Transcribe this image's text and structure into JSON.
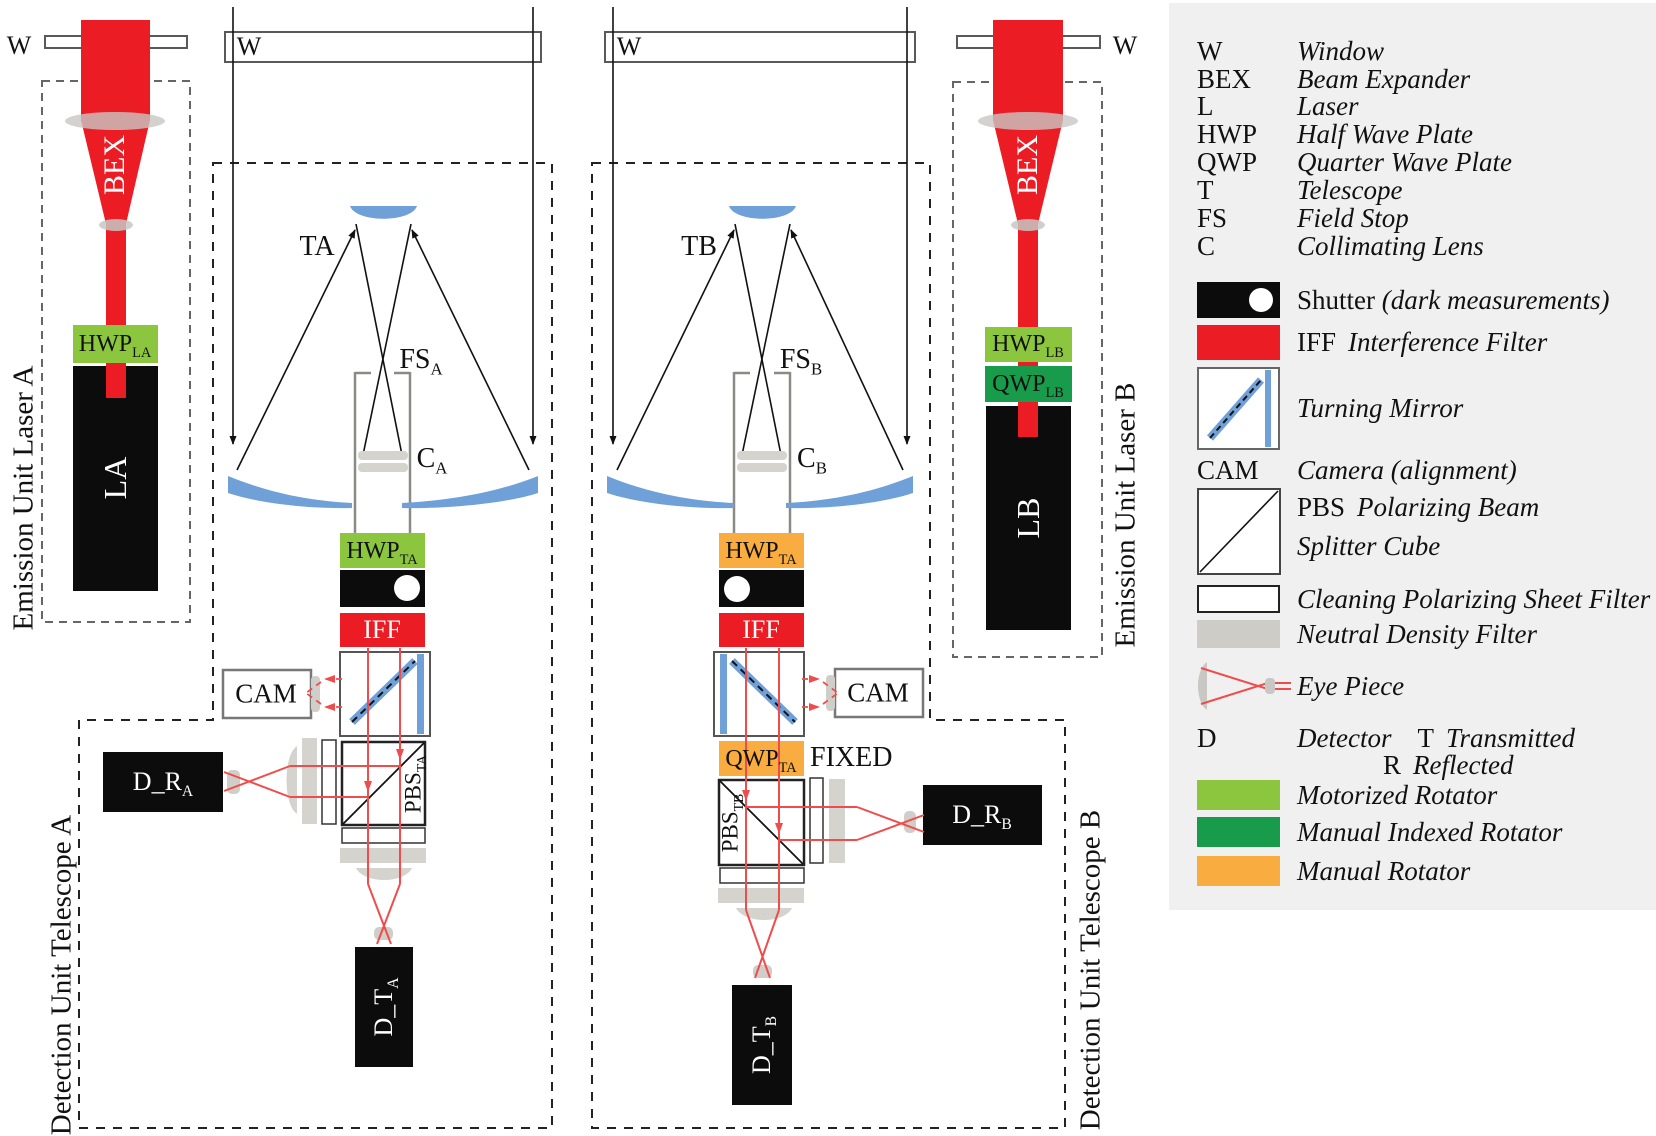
{
  "colors": {
    "beam_red": "#EC1C24",
    "ray_red": "#F04C4C",
    "mirror_blue": "#6FA0D8",
    "motorized_rotator_green": "#8CC63E",
    "manual_indexed_rotator_green": "#189C4B",
    "manual_rotator_orange": "#F9AC40",
    "optic_gray": "#D4D3CE",
    "legend_background": "#F0F0F0"
  },
  "units": {
    "emission_a": {
      "label": "Emission Unit Laser A",
      "window_label": "W",
      "bex": "BEX",
      "hwp": {
        "main": "HWP",
        "sub": "LA"
      },
      "laser": "LA"
    },
    "telescope_a": {
      "window_label": "W",
      "name": "TA",
      "field_stop": {
        "main": "FS",
        "sub": "A"
      },
      "collimator": {
        "main": "C",
        "sub": "A"
      }
    },
    "detection_a": {
      "label": "Detection Unit Telescope A",
      "hwp": {
        "main": "HWP",
        "sub": "TA"
      },
      "iff": "IFF",
      "cam": "CAM",
      "pbs": {
        "main": "PBS",
        "sub": "TA"
      },
      "detector_reflected": {
        "main": "D_R",
        "sub": "A"
      },
      "detector_transmitted": {
        "main": "D_T",
        "sub": "A"
      }
    },
    "telescope_b": {
      "window_label": "W",
      "name": "TB",
      "field_stop": {
        "main": "FS",
        "sub": "B"
      },
      "collimator": {
        "main": "C",
        "sub": "B"
      }
    },
    "detection_b": {
      "label": "Detection Unit Telescope B",
      "hwp": {
        "main": "HWP",
        "sub": "TA"
      },
      "iff": "IFF",
      "cam": "CAM",
      "qwp": {
        "main": "QWP",
        "sub": "TA"
      },
      "qwp_note": "FIXED",
      "pbs": {
        "main": "PBS",
        "sub": "TB"
      },
      "detector_reflected": {
        "main": "D_R",
        "sub": "B"
      },
      "detector_transmitted": {
        "main": "D_T",
        "sub": "B"
      }
    },
    "emission_b": {
      "label": "Emission Unit Laser B",
      "window_label": "W",
      "bex": "BEX",
      "hwp": {
        "main": "HWP",
        "sub": "LB"
      },
      "qwp": {
        "main": "QWP",
        "sub": "LB"
      },
      "laser": "LB"
    }
  },
  "legend": {
    "abbrev_rows": [
      {
        "abbr": "W",
        "desc": "Window"
      },
      {
        "abbr": "BEX",
        "desc": "Beam Expander"
      },
      {
        "abbr": "L",
        "desc": "Laser"
      },
      {
        "abbr": "HWP",
        "desc": "Half Wave Plate"
      },
      {
        "abbr": "QWP",
        "desc": "Quarter Wave Plate"
      },
      {
        "abbr": "T",
        "desc": "Telescope"
      },
      {
        "abbr": "FS",
        "desc": "Field Stop"
      },
      {
        "abbr": "C",
        "desc": "Collimating Lens"
      }
    ],
    "shutter": {
      "label": "Shutter",
      "note": "(dark measurements)"
    },
    "iff": {
      "abbr": "IFF",
      "desc": "Interference Filter"
    },
    "turning_mirror": "Turning Mirror",
    "cam": {
      "abbr": "CAM",
      "desc": "Camera (alignment)"
    },
    "pbs": {
      "abbr": "PBS",
      "desc_line1": "Polarizing Beam",
      "desc_line2": "Splitter Cube"
    },
    "cleaning_filter": "Cleaning Polarizing Sheet Filter",
    "nd_filter": "Neutral Density Filter",
    "eye_piece": "Eye Piece",
    "detector": {
      "abbr": "D",
      "desc": "Detector",
      "t": "T",
      "t_desc": "Transmitted",
      "r": "R",
      "r_desc": "Reflected"
    },
    "rotators": [
      {
        "label": "Motorized Rotator"
      },
      {
        "label": "Manual Indexed Rotator"
      },
      {
        "label": "Manual Rotator"
      }
    ]
  }
}
